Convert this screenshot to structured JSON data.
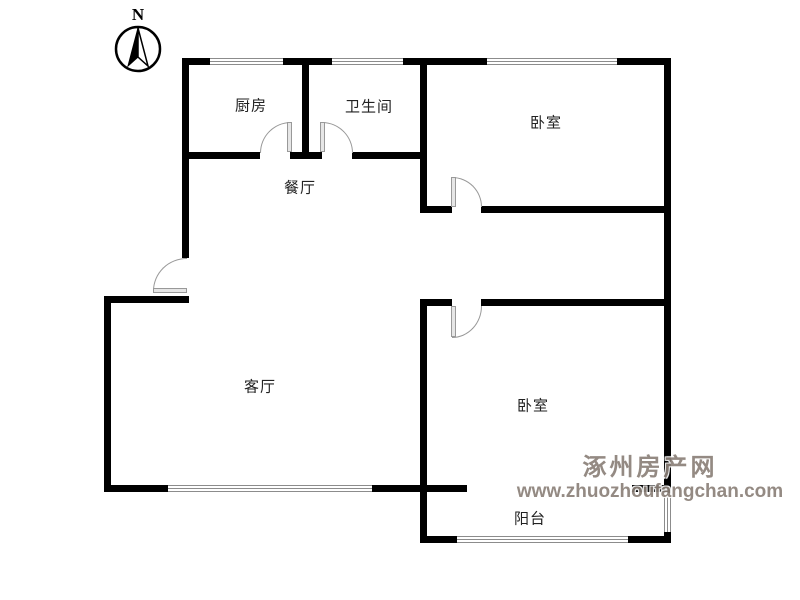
{
  "compass": {
    "label": "N"
  },
  "rooms": [
    {
      "id": "kitchen",
      "label": "厨房"
    },
    {
      "id": "bathroom",
      "label": "卫生间"
    },
    {
      "id": "dining-room",
      "label": "餐厅"
    },
    {
      "id": "bedroom-north",
      "label": "卧室"
    },
    {
      "id": "living-room",
      "label": "客厅"
    },
    {
      "id": "bedroom-south",
      "label": "卧室"
    },
    {
      "id": "balcony",
      "label": "阳台"
    }
  ],
  "watermark": {
    "site_name": "涿州房产网",
    "site_url": "www.zhuozhoufangchan.com",
    "text_color": "#8b8179"
  },
  "colors": {
    "wall": "#000000",
    "background": "#ffffff",
    "door_arc": "#999999",
    "window_line": "#8c8c8c"
  }
}
